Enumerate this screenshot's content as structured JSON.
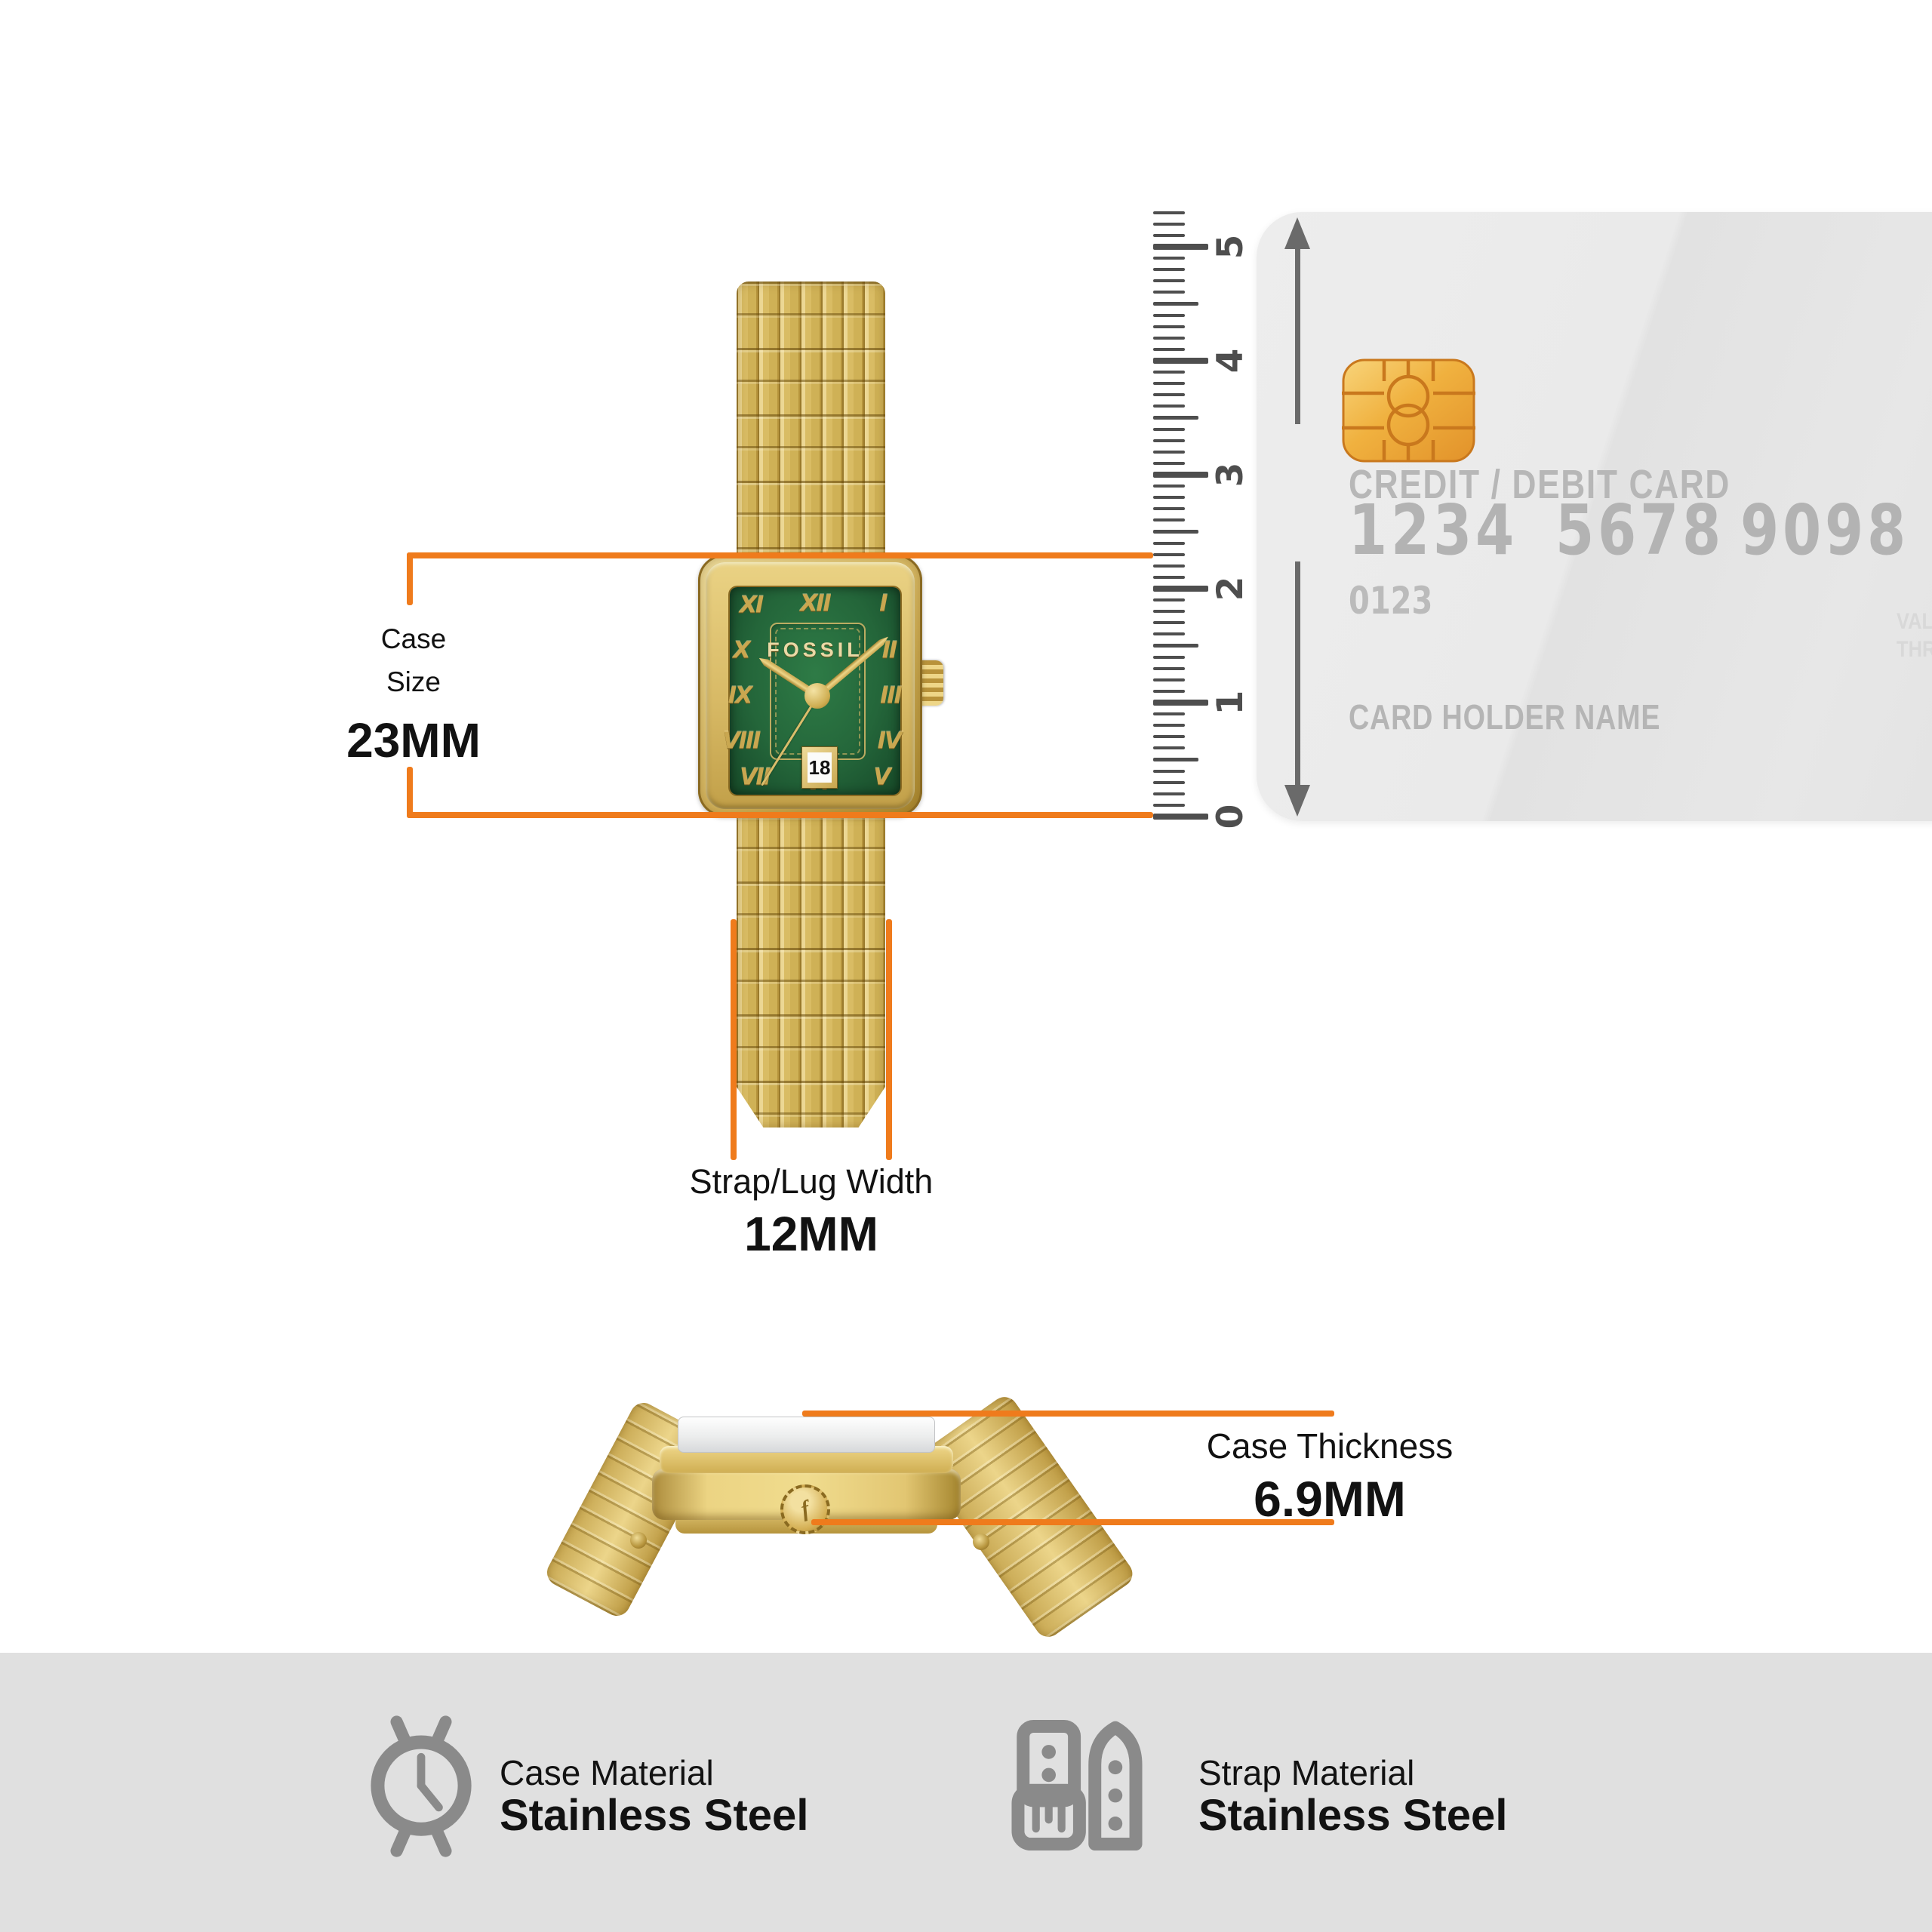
{
  "watch": {
    "brand": "FOSSIL",
    "date_value": "18",
    "numerals": {
      "n12": "XII",
      "n1": "I",
      "n2": "II",
      "n3": "III",
      "n4": "IV",
      "n5": "V",
      "n6": "VI",
      "n7": "VII",
      "n8": "VIII",
      "n9": "IX",
      "n10": "X",
      "n11": "XI"
    }
  },
  "measurements": {
    "case_size": {
      "label_line1": "Case",
      "label_line2": "Size",
      "value": "23MM"
    },
    "strap_width": {
      "label": "Strap/Lug Width",
      "value": "12MM"
    },
    "case_thickness": {
      "label": "Case Thickness",
      "value": "6.9MM"
    }
  },
  "ruler": {
    "labels": [
      "0",
      "1",
      "2",
      "3",
      "4",
      "5"
    ]
  },
  "card": {
    "title": "CREDIT / DEBIT CARD",
    "number_groups": [
      "1234",
      "5678",
      "9098"
    ],
    "code": "0123",
    "holder_label": "CARD HOLDER NAME",
    "height_label": "54mm",
    "valid_text_line1": "VAL",
    "valid_text_line2": "THR"
  },
  "footer": {
    "items": [
      {
        "label": "Case Material",
        "value": "Stainless Steel"
      },
      {
        "label": "Strap Material",
        "value": "Stainless Steel"
      }
    ]
  },
  "colors": {
    "accent_orange": "#EF7B1C",
    "dial_green": "#25683A",
    "gold": "#D7B95F",
    "card_gray": "#E9E9E9",
    "footer_bg": "#E0E0E0",
    "icon_gray": "#8A8A8A",
    "ruler_gray": "#4E4E4E"
  }
}
